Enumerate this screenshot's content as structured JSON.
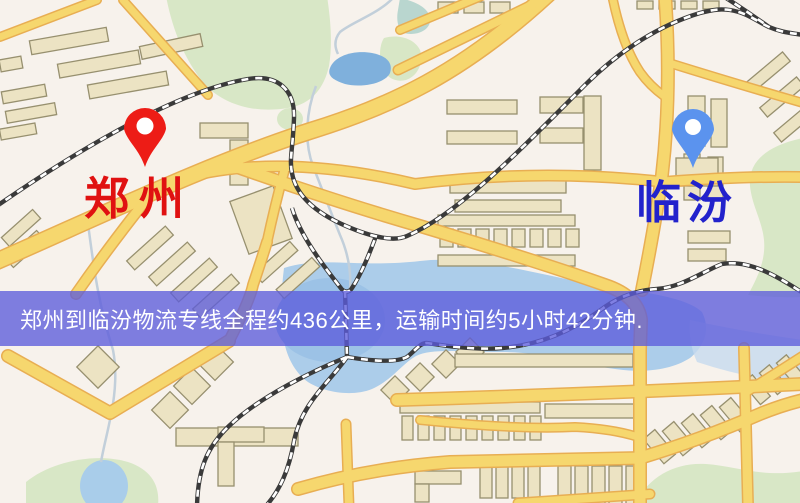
{
  "labels": {
    "origin": "郑州",
    "destination": "临汾"
  },
  "banner": {
    "text": "郑州到临汾物流专线全程约436公里，运输时间约5小时42分钟.",
    "distance_text": "约436公里",
    "duration_text": "约5小时42分钟",
    "bg_color": "#5c5cdb",
    "text_color": "#ffffff"
  },
  "colors": {
    "background": "#f7f2ec",
    "origin_pin": "#ed1c16",
    "origin_label": "#e01111",
    "destination_pin": "#5b93ee",
    "destination_label": "#2222cc",
    "road": "#f6d76e",
    "road_casing": "#e8ae53",
    "park": "#d8e7c6",
    "water": "#accdea",
    "lake": "#7fb0dc",
    "building": "#ece3c3",
    "railway": "#3a3a3a"
  }
}
